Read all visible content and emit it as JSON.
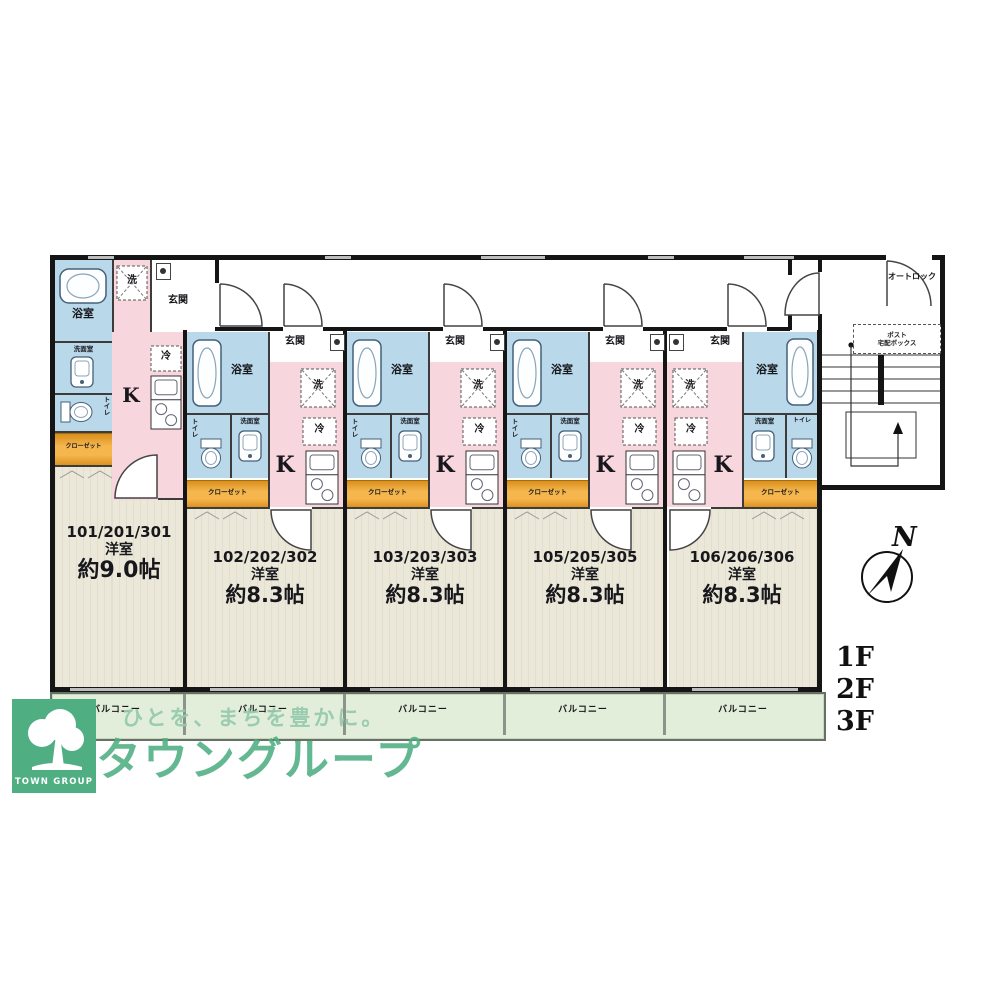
{
  "plan": {
    "room_labels": {
      "bath": "浴室",
      "washroom": "洗面室",
      "toilet": "トイレ",
      "entrance": "玄関",
      "washer": "洗",
      "fridge": "冷",
      "kitchen": "K",
      "closet": "クローゼット",
      "balcony": "バルコニー"
    },
    "units": [
      {
        "id": "101/201/301",
        "type": "洋室",
        "size": "約9.0帖"
      },
      {
        "id": "102/202/302",
        "type": "洋室",
        "size": "約8.3帖"
      },
      {
        "id": "103/203/303",
        "type": "洋室",
        "size": "約8.3帖"
      },
      {
        "id": "105/205/305",
        "type": "洋室",
        "size": "約8.3帖"
      },
      {
        "id": "106/206/306",
        "type": "洋室",
        "size": "約8.3帖"
      }
    ],
    "entrance_area": {
      "autolock": "オートロック",
      "post": "ポスト",
      "delivery_box": "宅配ボックス"
    },
    "floors": [
      "1F",
      "2F",
      "3F"
    ],
    "compass_north": "N"
  },
  "branding": {
    "company_jp": "タウングループ",
    "company_en": "TOWN GROUP",
    "tagline": "ひとを、まちを豊かに。"
  },
  "colors": {
    "wall": "#151515",
    "wet_area": "#b9d8ea",
    "kitchen": "#f8d6de",
    "closet": "#f5b64e",
    "room": "#ebe8d9",
    "balcony": "#e2eeda",
    "brand_green": "#4fae82"
  }
}
